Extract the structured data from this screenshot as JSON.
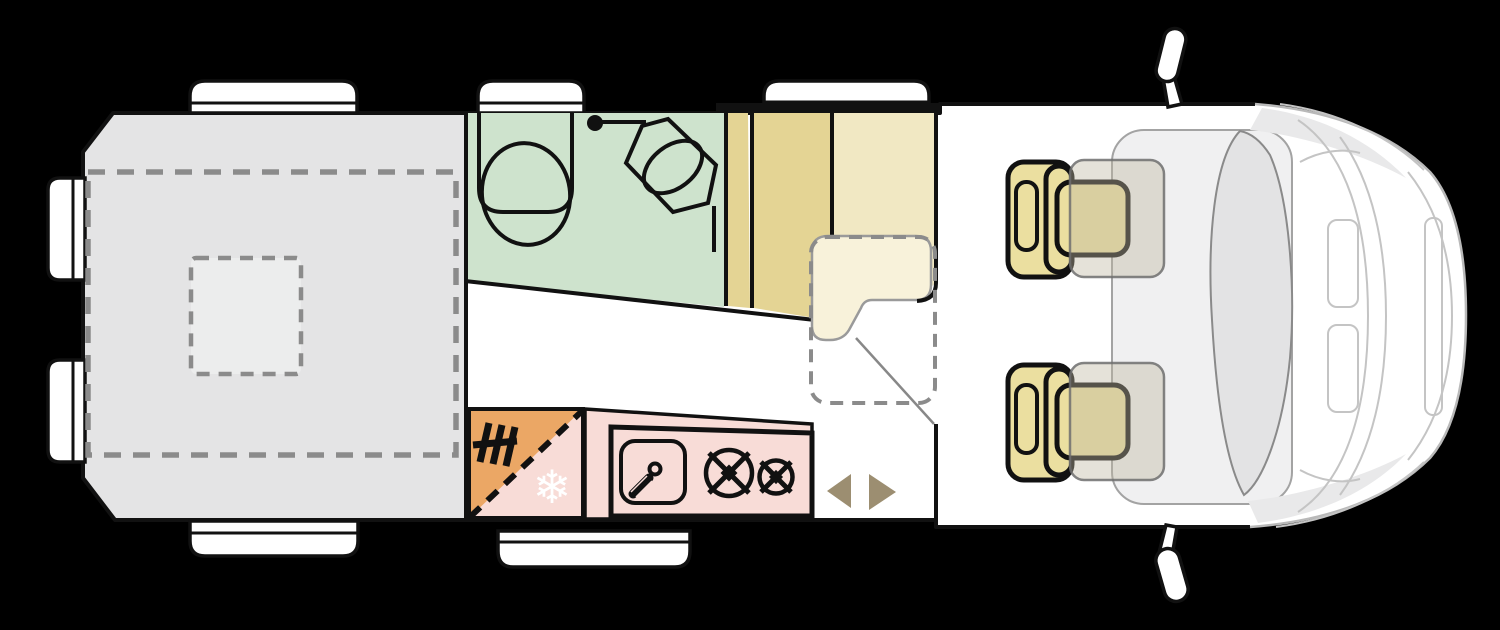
{
  "canvas": {
    "width": 1500,
    "height": 630,
    "background": "#000000"
  },
  "diagram": {
    "title": "Campervan floor plan (top view)",
    "body_fill": "#ffffff",
    "outline_color": "#111111",
    "front_line_color": "#bdbdbd"
  },
  "areas": [
    {
      "id": "rear-bed",
      "label": "Rear bed / storage area",
      "color": "#e4e4e5"
    },
    {
      "id": "roof-hatch",
      "label": "Roof hatch / skylight",
      "color": "#ededee"
    },
    {
      "id": "bathroom",
      "label": "Bathroom",
      "color": "#cee3cd"
    },
    {
      "id": "wardrobe",
      "label": "Wardrobe columns",
      "color": "#e4d494"
    },
    {
      "id": "bench-seat",
      "label": "Bench seat",
      "color": "#f1e8c3"
    },
    {
      "id": "seat-cushion",
      "label": "Seat cushion",
      "color": "#f8f2da"
    },
    {
      "id": "kitchen",
      "label": "Kitchen counter",
      "color": "#f8dcd7"
    },
    {
      "id": "heater",
      "label": "Heater corner",
      "color": "#eba765"
    },
    {
      "id": "cab",
      "label": "Driver cab",
      "color": "#f0f0f1"
    },
    {
      "id": "cab-seats",
      "label": "Swivel cab seats",
      "color": "#ebdfa0"
    }
  ],
  "icons": {
    "snowflake_glyph": "❄",
    "snowflake_label": "fridge",
    "toilet_label": "toilet",
    "shower_label": "shower",
    "sink_label": "sink",
    "burners_label": "two-burner hob",
    "heater_label": "heating",
    "door_arrows_label": "sliding door",
    "arrow_color": "#9c8e71",
    "dashed_color": "#8b8b8b"
  }
}
